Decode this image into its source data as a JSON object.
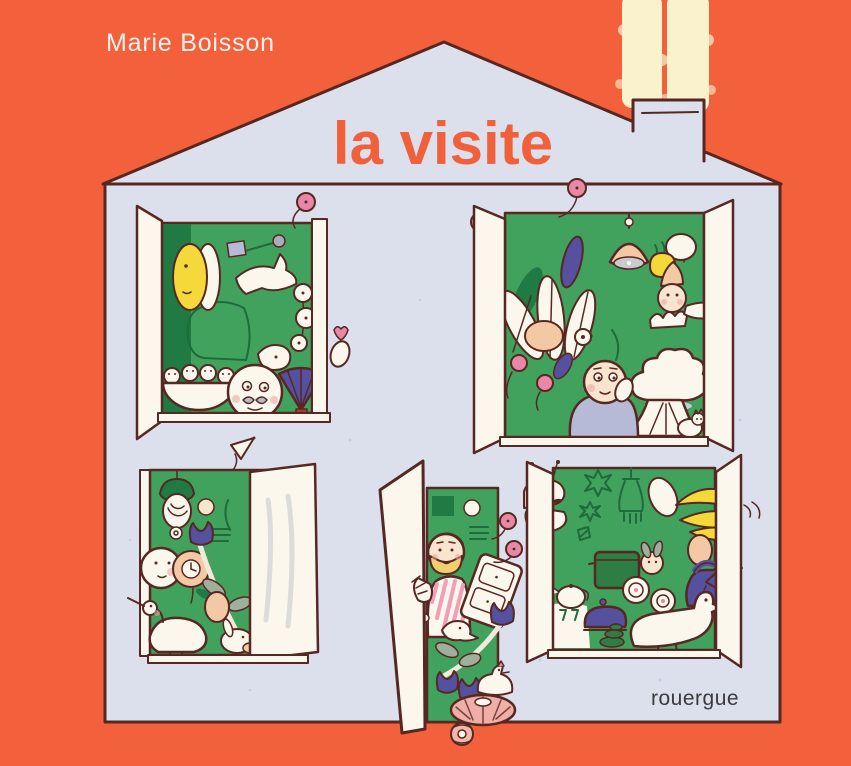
{
  "cover": {
    "author": "Marie Boisson",
    "title": "la visite",
    "publisher": "rouergue"
  },
  "colors": {
    "orange": "#F2613C",
    "wall": "#DCE0ED",
    "ink": "#572722",
    "green": "#41A25E",
    "greenDark": "#1F7A44",
    "greenLine": "#1F6B3C",
    "cream": "#FBF7EC",
    "smoke": "#FAF1CD",
    "pink": "#E987A6",
    "pinkLight": "#F0AFA6",
    "yellow": "#F5D93B",
    "indigo": "#55519E",
    "peach": "#F3C9A5",
    "lavender": "#B7BAD6",
    "red": "#B13A2D",
    "grayLeaf": "#9FAF9B",
    "titleColor": "#F0603B",
    "authorColor": "#F6F1EA",
    "publisherColor": "#3B3B3B"
  },
  "illustration": {
    "house": [
      "gable-roof",
      "chimney",
      "smoke",
      "lavender-wall"
    ],
    "window_top_left": [
      "open-shutter",
      "yellow-moon-face",
      "white-bird",
      "bowl-of-chicks",
      "mustache-creature",
      "indigo-hand-fan",
      "berry-flowers",
      "goat-head",
      "pink-balloon"
    ],
    "window_top_right": [
      "open-shutters",
      "hanging-lamp",
      "house-plants",
      "broccoli-tree-lady",
      "leaning-figure",
      "yellow-apple",
      "white-cat",
      "pink-balloons"
    ],
    "window_bottom_left": [
      "green-lamp",
      "peeking-face",
      "clock-flower",
      "indigo-tulips",
      "long-beaked-bird",
      "rabbit",
      "paper-flag",
      "open-shutter"
    ],
    "door_bottom_middle": [
      "open-door",
      "bearded-man-waving",
      "pink-striped-shirt",
      "tilted-dresser",
      "indigo-tulips",
      "goat-head",
      "white-hen",
      "pink-pouf",
      "pink-balloons",
      "pink-flower"
    ],
    "window_bottom_right": [
      "butterfly-mask",
      "outline-stars",
      "chandelier",
      "cooking-pot",
      "teapot",
      "indigo-iron",
      "white-goose",
      "indigo-watering-can",
      "banana-bunch",
      "cake-plates"
    ]
  }
}
